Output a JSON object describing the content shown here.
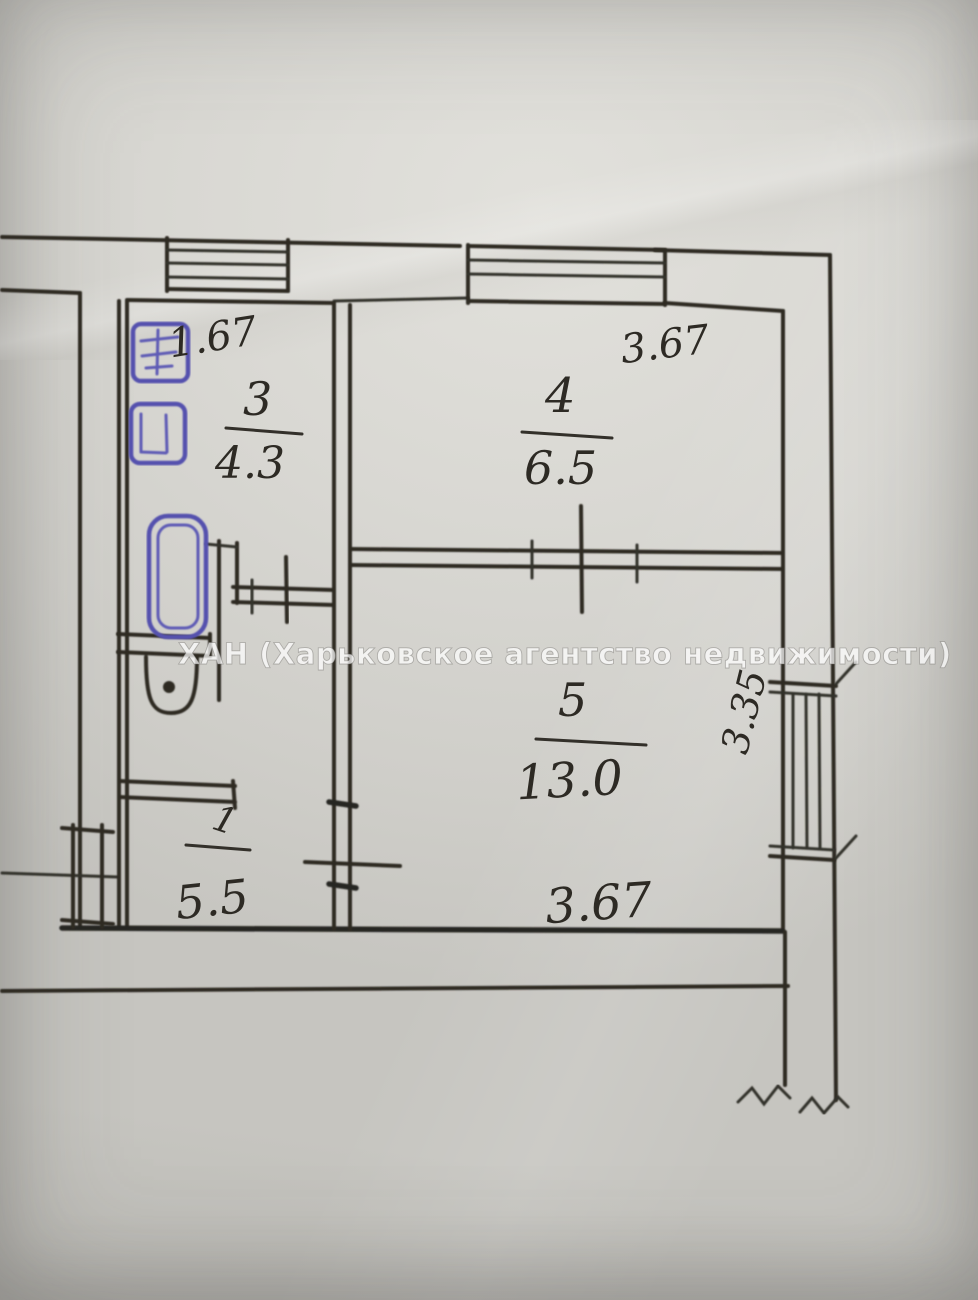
{
  "watermark": {
    "text": "ХАН (Харьковское агентство недвижимости)"
  },
  "rooms": [
    {
      "number": "3",
      "area": "4.3"
    },
    {
      "number": "4",
      "area": "6.5"
    },
    {
      "number": "5",
      "area": "13.0"
    },
    {
      "number": "1",
      "area": "5.5"
    }
  ],
  "dimensions": [
    {
      "label": "1.67",
      "location": "room-3-top-width"
    },
    {
      "label": "3.67",
      "location": "room-4-top-width"
    },
    {
      "label": "3.35",
      "location": "room-5-right-height"
    },
    {
      "label": "3.67",
      "location": "room-5-bottom-width"
    }
  ],
  "fixtures": [
    {
      "icon": "bathtub-icon",
      "ink_color": "blue"
    },
    {
      "icon": "toilet-icon",
      "ink_color": "black"
    },
    {
      "icon": "sink-icon",
      "ink_color": "blue"
    },
    {
      "icon": "stove-icon",
      "ink_color": "blue"
    }
  ],
  "symbols": [
    {
      "icon": "window-icon",
      "count": 3
    },
    {
      "icon": "door-opening-icon",
      "count": 5
    },
    {
      "icon": "wall-break-icon",
      "count": 2
    }
  ],
  "colors": {
    "ink": "#2d2a24",
    "blue_ink": "#5551ae",
    "paper_light": "#e2e1dc",
    "paper_dark": "#c6c5c0"
  }
}
